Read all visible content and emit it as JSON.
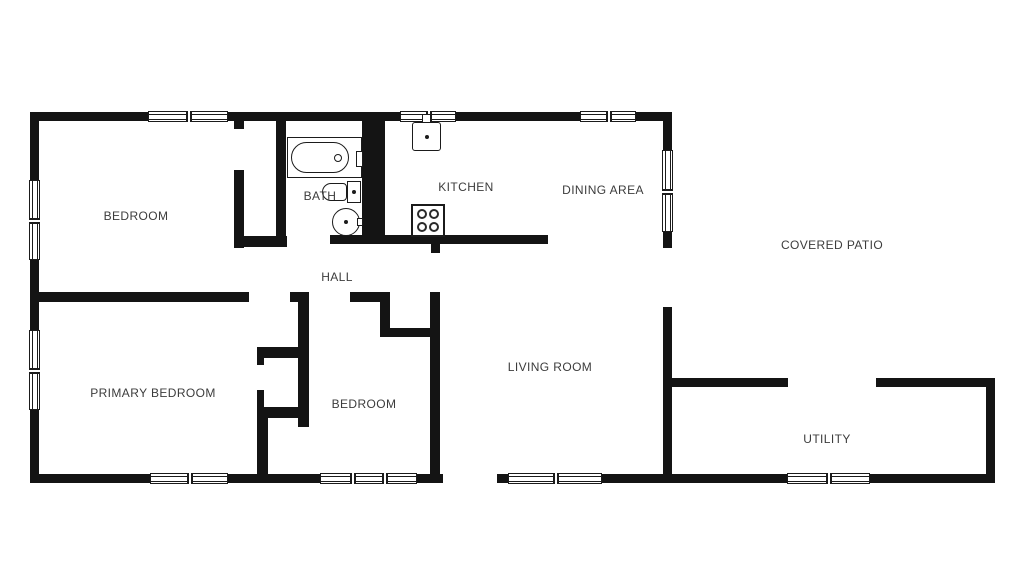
{
  "plan_title": "Single-story house floor plan",
  "colors": {
    "wall": "#141414",
    "line": "#1b1b1b",
    "label_text": "#3c3c3c",
    "background": "#ffffff"
  },
  "rooms": [
    {
      "id": "bedroom-top-left",
      "label": "BEDROOM"
    },
    {
      "id": "bath",
      "label": "BATH"
    },
    {
      "id": "kitchen",
      "label": "KITCHEN"
    },
    {
      "id": "dining-area",
      "label": "DINING AREA"
    },
    {
      "id": "covered-patio",
      "label": "COVERED PATIO"
    },
    {
      "id": "hall",
      "label": "HALL"
    },
    {
      "id": "living-room",
      "label": "LIVING ROOM"
    },
    {
      "id": "primary-bedroom",
      "label": "PRIMARY BEDROOM"
    },
    {
      "id": "bedroom-middle",
      "label": "BEDROOM"
    },
    {
      "id": "utility",
      "label": "UTILITY"
    }
  ],
  "fixtures": {
    "bathtub": "bathtub-icon",
    "toilet": "toilet-icon",
    "bath_sink": "pedestal-sink-icon",
    "kitchen_sink": "kitchen-sink-icon",
    "stove": "stove-burners-icon"
  }
}
